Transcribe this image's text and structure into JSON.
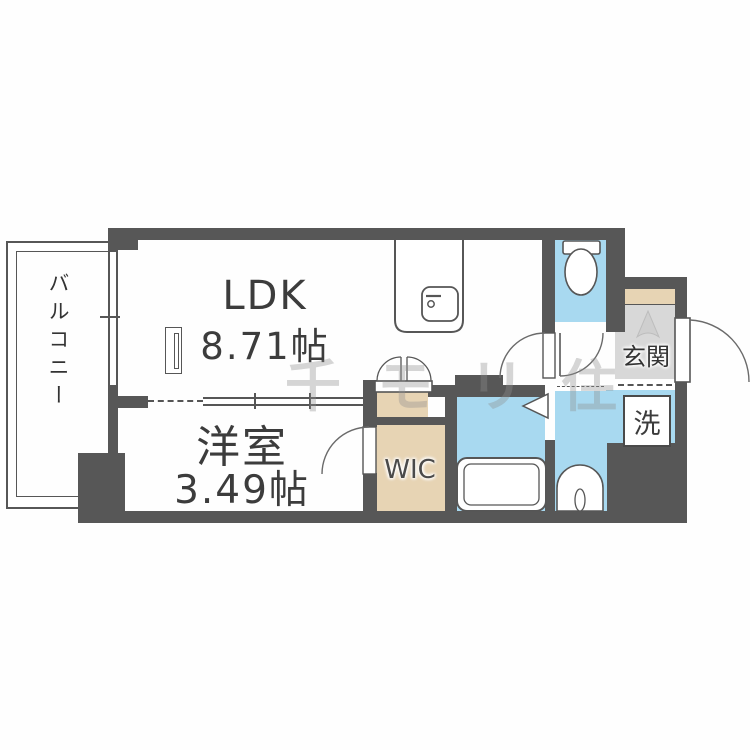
{
  "floorplan": {
    "type": "apartment-floorplan",
    "rooms": {
      "ldk": {
        "label": "LDK",
        "size": "8.71帖"
      },
      "bedroom": {
        "label": "洋室",
        "size": "3.49帖"
      },
      "balcony": {
        "label": "バルコニー"
      },
      "wic": {
        "label": "WIC"
      },
      "entrance": {
        "label": "玄関"
      },
      "laundry": {
        "label": "洗"
      }
    },
    "watermark": "千モリ住",
    "fixtures": [
      "kitchen-counter",
      "kitchen-sink",
      "toilet",
      "bathtub",
      "washbasin",
      "washing-machine-space",
      "shoe-cabinet",
      "double-closet-door",
      "folding-bath-door",
      "entrance-door",
      "balcony-window",
      "room-partition-window"
    ],
    "colors": {
      "wall": "#575757",
      "wet_area": "#a8d9f0",
      "storage": "#e7d4b4",
      "entrance_floor": "#d8d8d8",
      "line": "#565656",
      "text": "#3a3a3a"
    }
  }
}
